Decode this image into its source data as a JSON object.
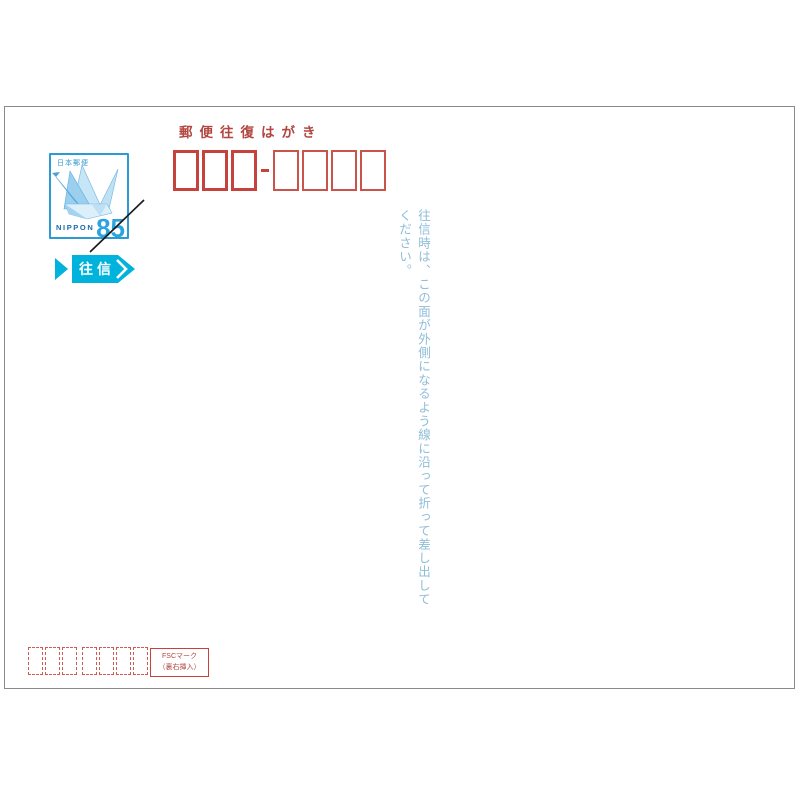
{
  "postcard": {
    "header_label": "郵便往復はがき",
    "stamp": {
      "issuer": "日本郵便",
      "country": "NIPPON",
      "denomination": "85",
      "design": "origami-crane",
      "struck_through": true
    },
    "direction_badge": {
      "label": "往信"
    },
    "postal_code": {
      "first_group_count": 3,
      "second_group_count": 4,
      "separator": "-"
    },
    "reverse_code_marks": {
      "first_group_count": 3,
      "second_group_count": 4
    },
    "fold_instruction": "往信時は、この面が外側になるよう線に沿って折って差し出してください。",
    "fsc_note": {
      "line1": "FSCマーク",
      "line2": "（裏右挿入）"
    },
    "colors": {
      "box_red": "#c5433c",
      "text_red": "#b2453e",
      "stamp_blue": "#2e9ad2",
      "denomination_blue": "#2aa3de",
      "nippon_navy": "#1a6aa6",
      "badge_cyan": "#00b3dd",
      "instruction_blue": "#8fbdd8",
      "card_border_gray": "#8a8a8a"
    }
  }
}
